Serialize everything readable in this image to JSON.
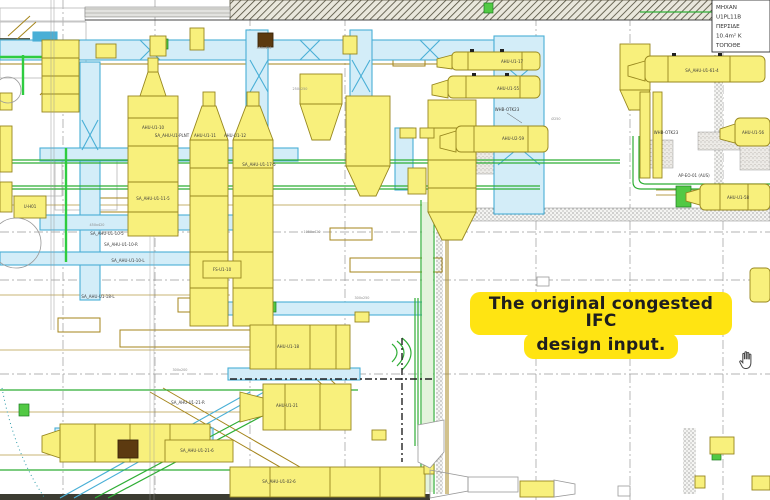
{
  "viewer": {
    "cursor": "hand-pan",
    "annotation": {
      "line1": "The original congested IFC",
      "line2": "design input.",
      "highlight_color": "#FFE412",
      "text_color": "#1E1E1E"
    }
  },
  "title_block": {
    "lines": [
      "ΜΗΧΑΝ",
      "U1PL11B",
      "ΠΕΡΣΙΔΕ",
      "10.4m² Κ",
      "ΤΟΠΟΘΕ"
    ]
  },
  "drawing": {
    "equipment_labels": [
      {
        "text": "AHU-U1-10",
        "x": 153,
        "y": 129
      },
      {
        "text": "SA_AHU-U1-PLNT",
        "x": 172,
        "y": 137
      },
      {
        "text": "AHU-U1-11",
        "x": 205,
        "y": 137
      },
      {
        "text": "AHU-U1-12",
        "x": 235,
        "y": 137
      },
      {
        "text": "SA_AHU-U1-17-5",
        "x": 259,
        "y": 166
      },
      {
        "text": "SA_AHU-U1-11-5",
        "x": 153,
        "y": 200
      },
      {
        "text": "SA_AHU-U1-10-5",
        "x": 107,
        "y": 235
      },
      {
        "text": "SA_AHU-U1-10-R",
        "x": 121,
        "y": 246
      },
      {
        "text": "SA_AHU-U1-10-L",
        "x": 128,
        "y": 262
      },
      {
        "text": "SA_AHU-U1-18-L",
        "x": 98,
        "y": 298
      },
      {
        "text": "FS-U1-10",
        "x": 222,
        "y": 271
      },
      {
        "text": "U-H01",
        "x": 30,
        "y": 208
      },
      {
        "text": "AHU-U1-17",
        "x": 512,
        "y": 63
      },
      {
        "text": "AHU-U1-55",
        "x": 508,
        "y": 90
      },
      {
        "text": "WHB-OTK23",
        "x": 507,
        "y": 111
      },
      {
        "text": "AHU-U2-59",
        "x": 513,
        "y": 140
      },
      {
        "text": "SA_AHU-U1-61-4",
        "x": 702,
        "y": 72
      },
      {
        "text": "WHB-OTK23",
        "x": 666,
        "y": 134
      },
      {
        "text": "AHU-U1-56",
        "x": 753,
        "y": 134
      },
      {
        "text": "AHU-U1-58",
        "x": 738,
        "y": 199
      },
      {
        "text": "AP-EO-01 (AUS)",
        "x": 694,
        "y": 177
      },
      {
        "text": "AHU-U1-18",
        "x": 288,
        "y": 348
      },
      {
        "text": "AHU-U1-21",
        "x": 287,
        "y": 407
      },
      {
        "text": "SA_AHU-U1-21-R",
        "x": 188,
        "y": 404
      },
      {
        "text": "SA_AHU-U1-21-6",
        "x": 197,
        "y": 452
      },
      {
        "text": "SA_AHU-U1-02-6",
        "x": 279,
        "y": 483
      }
    ],
    "size_annotations": [
      {
        "text": "350x420",
        "x": 264,
        "y": 49
      },
      {
        "text": "250x250",
        "x": 300,
        "y": 90
      },
      {
        "text": "1050x420",
        "x": 312,
        "y": 233
      },
      {
        "text": "450x420",
        "x": 97,
        "y": 226
      },
      {
        "text": "Ø250",
        "x": 556,
        "y": 120
      },
      {
        "text": "300x250",
        "x": 362,
        "y": 299
      },
      {
        "text": "300x200",
        "x": 180,
        "y": 371
      }
    ],
    "palette": {
      "duct_cyan": "#49AFD6",
      "duct_cyan_fill": "#D3EDF8",
      "equipment_yellow": "#F8F07C",
      "equipment_outline": "#97871E",
      "piping_green": "#2FAE35",
      "duct_tan": "#A5851B",
      "grid_gray": "#9A9A9A"
    }
  }
}
